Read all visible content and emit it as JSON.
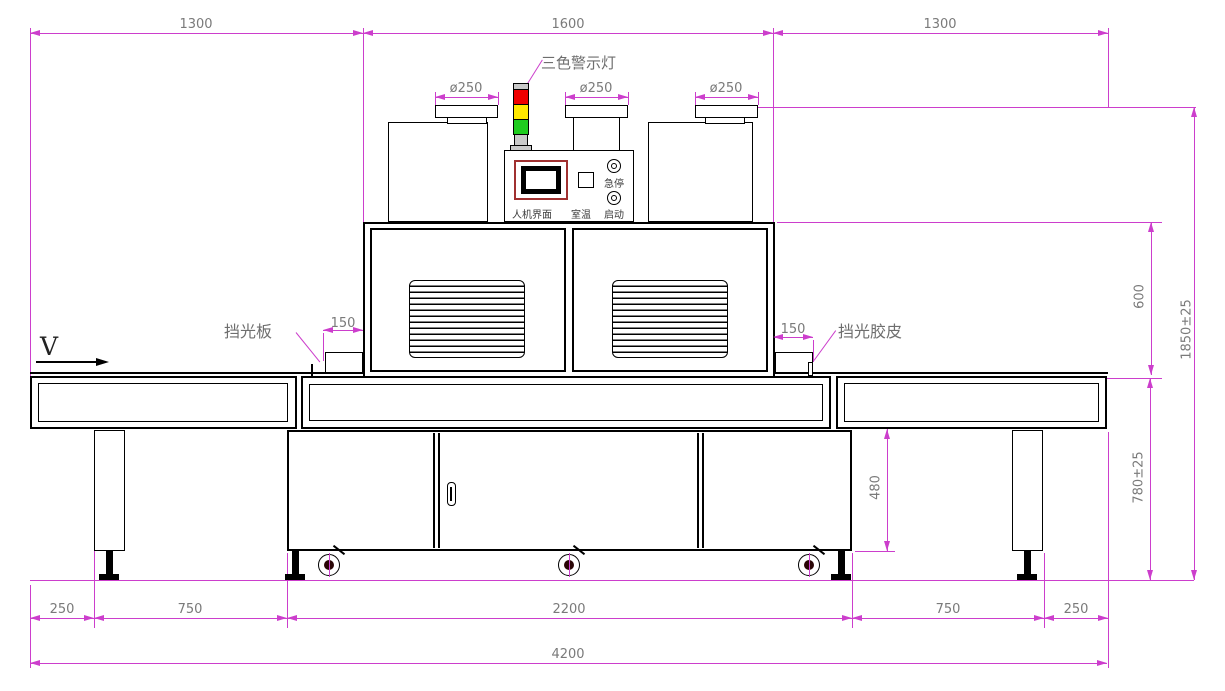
{
  "drawing": {
    "labels": {
      "warning_light": "三色警示灯",
      "light_block_plate": "挡光板",
      "light_block_rubber": "挡光胶皮",
      "direction_mark": "V"
    },
    "panel": {
      "hmi": "人机界面",
      "room_temp": "室温",
      "start": "启动",
      "estop": "急停"
    },
    "dimensions": {
      "top": [
        "1300",
        "1600",
        "1300"
      ],
      "duct": [
        "ø250",
        "ø250",
        "ø250"
      ],
      "side_gap": [
        "150",
        "150"
      ],
      "right": {
        "body_height": "600",
        "total_height": "1850±25",
        "table_height": "780±25",
        "cabinet_height": "480"
      },
      "bottom": [
        "250",
        "750",
        "2200",
        "750",
        "250"
      ],
      "total_width": "4200"
    },
    "colors": {
      "dimension_line": "#cc3ecc",
      "drawing_line": "#000000",
      "lamp_red": "#f00000",
      "lamp_yellow": "#ffe800",
      "lamp_green": "#1fcc1f",
      "lamp_gray": "#c9c9c9"
    }
  }
}
